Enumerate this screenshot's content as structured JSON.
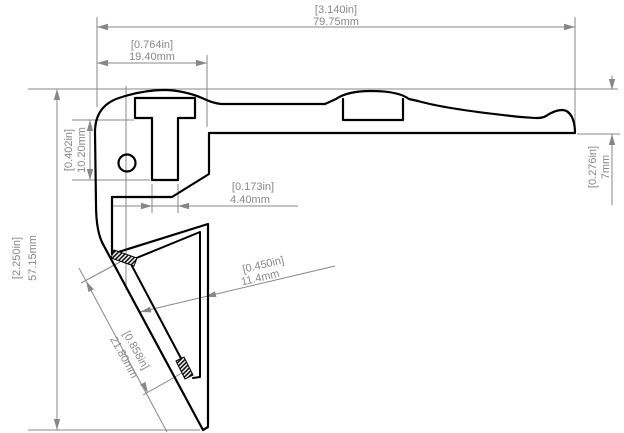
{
  "dims": {
    "total_width": {
      "in": "[3.140in]",
      "mm": "79.75mm"
    },
    "channel_block_width": {
      "in": "[0.764in]",
      "mm": "19.40mm"
    },
    "slot_depth": {
      "in": "[0.402in]",
      "mm": "10.20mm"
    },
    "total_height": {
      "in": "[2.250in]",
      "mm": "57.15mm"
    },
    "slot_width": {
      "in": "[0.173in]",
      "mm": "4.40mm"
    },
    "edge_height": {
      "in": "[0.276in]",
      "mm": "7mm"
    },
    "insert_depth": {
      "in": "[0.450in]",
      "mm": "11.4mm"
    },
    "insert_length": {
      "in": "[0.858in]",
      "mm": "21.80mm"
    }
  },
  "colors": {
    "outline": "#000000",
    "dimension": "#878787",
    "background": "#ffffff"
  }
}
